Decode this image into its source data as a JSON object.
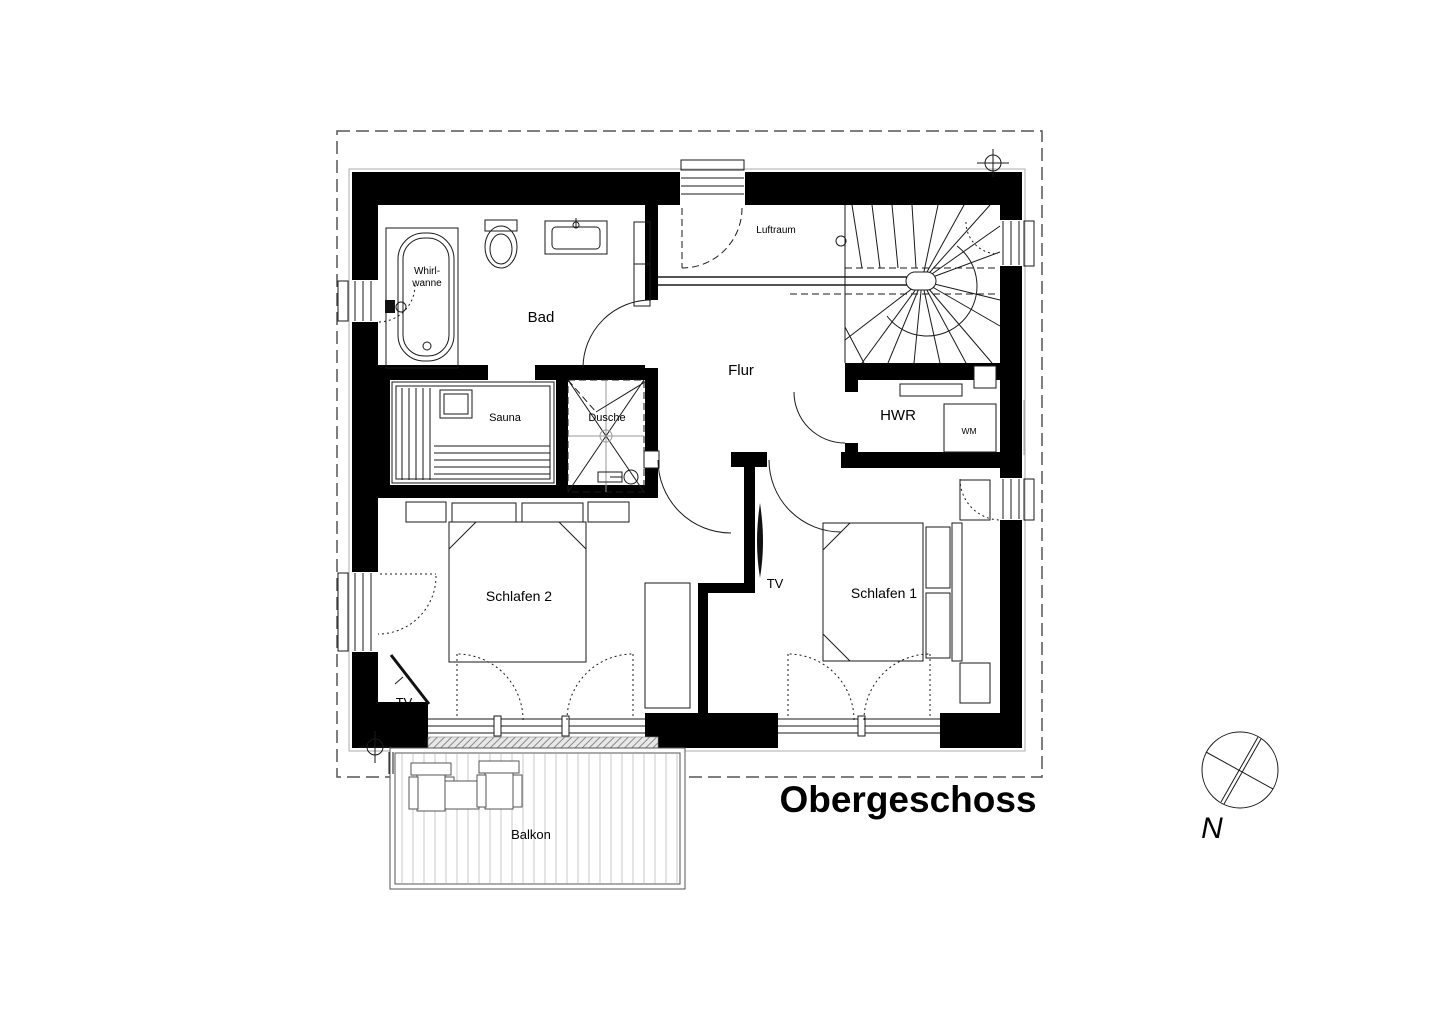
{
  "title": "Obergeschoss",
  "compass": {
    "label": "N"
  },
  "labels": {
    "bad": "Bad",
    "whirlpool_line1": "Whirl-",
    "whirlpool_line2": "wanne",
    "sauna": "Sauna",
    "dusche": "Dusche",
    "flur": "Flur",
    "luftraum": "Luftraum",
    "hwr": "HWR",
    "wm": "WM",
    "schlafen1": "Schlafen 1",
    "schlafen2": "Schlafen 2",
    "tv_schlafen1": "TV",
    "tv_schlafen2": "TV",
    "balkon": "Balkon"
  },
  "colors": {
    "wall": "#000000",
    "line": "#1a1a1a",
    "gray_line": "#9a9a9a",
    "decking": "#c9c9c9",
    "boundary": "#555555",
    "background": "#ffffff"
  },
  "icons": [
    "bathtub-icon",
    "faucet-icon",
    "toilet-icon",
    "sink-icon",
    "cabinet-icon",
    "sauna-heater-icon",
    "sauna-bench-icon",
    "shower-enclosure-icon",
    "shower-drain-icon",
    "shower-head-icon",
    "stairs-icon",
    "railing-icon",
    "washing-machine-icon",
    "shelf-icon",
    "bed-icon",
    "pillow-icon",
    "nightstand-icon",
    "wardrobe-icon",
    "tv-icon",
    "balcony-chair-icon",
    "balcony-table-icon",
    "compass-icon",
    "survey-point-icon"
  ]
}
